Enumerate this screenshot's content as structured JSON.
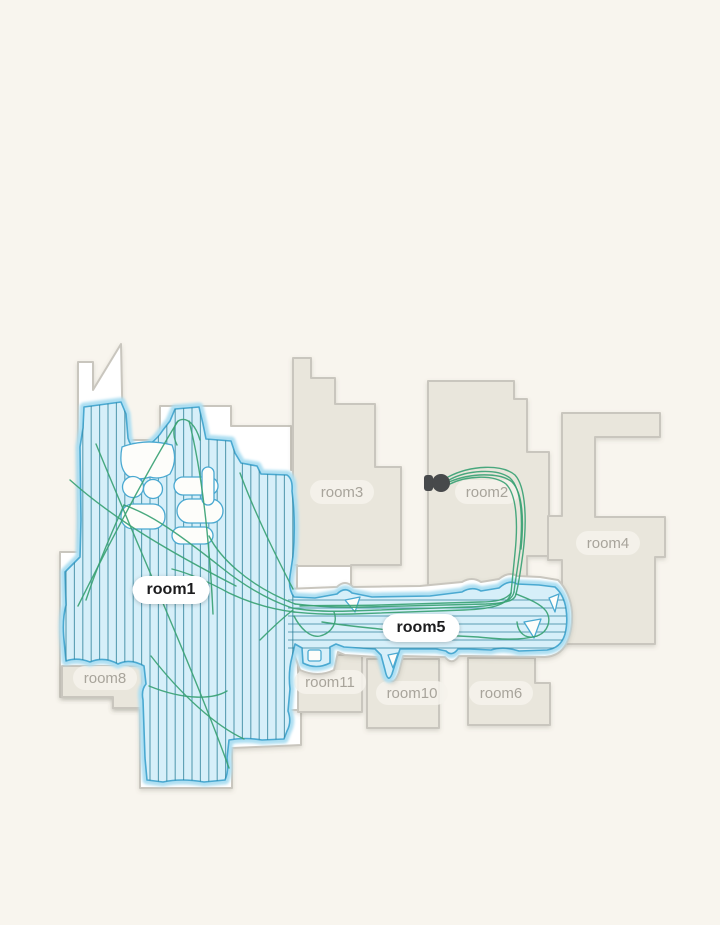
{
  "map": {
    "rooms": [
      {
        "id": "room1",
        "label": "room1",
        "selected": true
      },
      {
        "id": "room2",
        "label": "room2",
        "selected": false
      },
      {
        "id": "room3",
        "label": "room3",
        "selected": false
      },
      {
        "id": "room4",
        "label": "room4",
        "selected": false
      },
      {
        "id": "room5",
        "label": "room5",
        "selected": true
      },
      {
        "id": "room6",
        "label": "room6",
        "selected": false
      },
      {
        "id": "room8",
        "label": "room8",
        "selected": false
      },
      {
        "id": "room10",
        "label": "room10",
        "selected": false
      },
      {
        "id": "room11",
        "label": "room11",
        "selected": false
      }
    ],
    "colors": {
      "bg": "#f8f5ee",
      "room_fill": "#e9e6dc",
      "room_stroke": "#c9c6be",
      "clean_fill": "#d6eff9",
      "clean_glow": "#aedff2",
      "clean_stroke": "#4aa9d1",
      "hatch": "#2a7e97",
      "path_green": "#3aa274",
      "robot_color": "#47494b",
      "label_text": "#a8a49b",
      "label_selected_text": "#1c1c1e"
    }
  }
}
